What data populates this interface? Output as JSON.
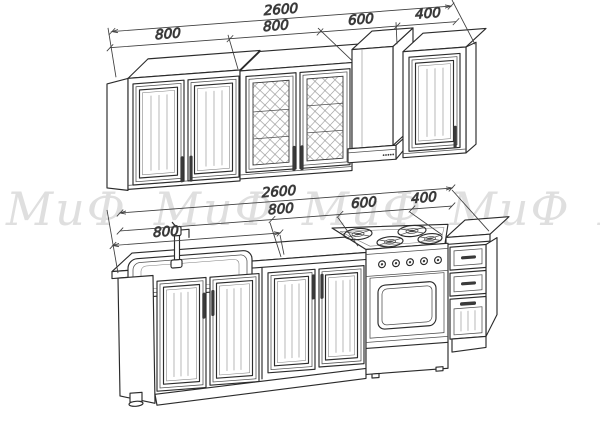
{
  "drawing": {
    "watermark": {
      "text": "МиФ",
      "color": "#dfdfdf"
    },
    "dims_upper": {
      "total": "2600",
      "seg1": "800",
      "seg2": "800",
      "seg3": "600",
      "seg4": "400"
    },
    "dims_lower": {
      "total": "2600",
      "sink": "800",
      "seg2": "800",
      "seg3": "600",
      "seg4": "400"
    },
    "colors": {
      "outline": "#2b2b2b",
      "detail": "#555555",
      "dimension": "#3f3f3f",
      "background": "#ffffff"
    }
  }
}
